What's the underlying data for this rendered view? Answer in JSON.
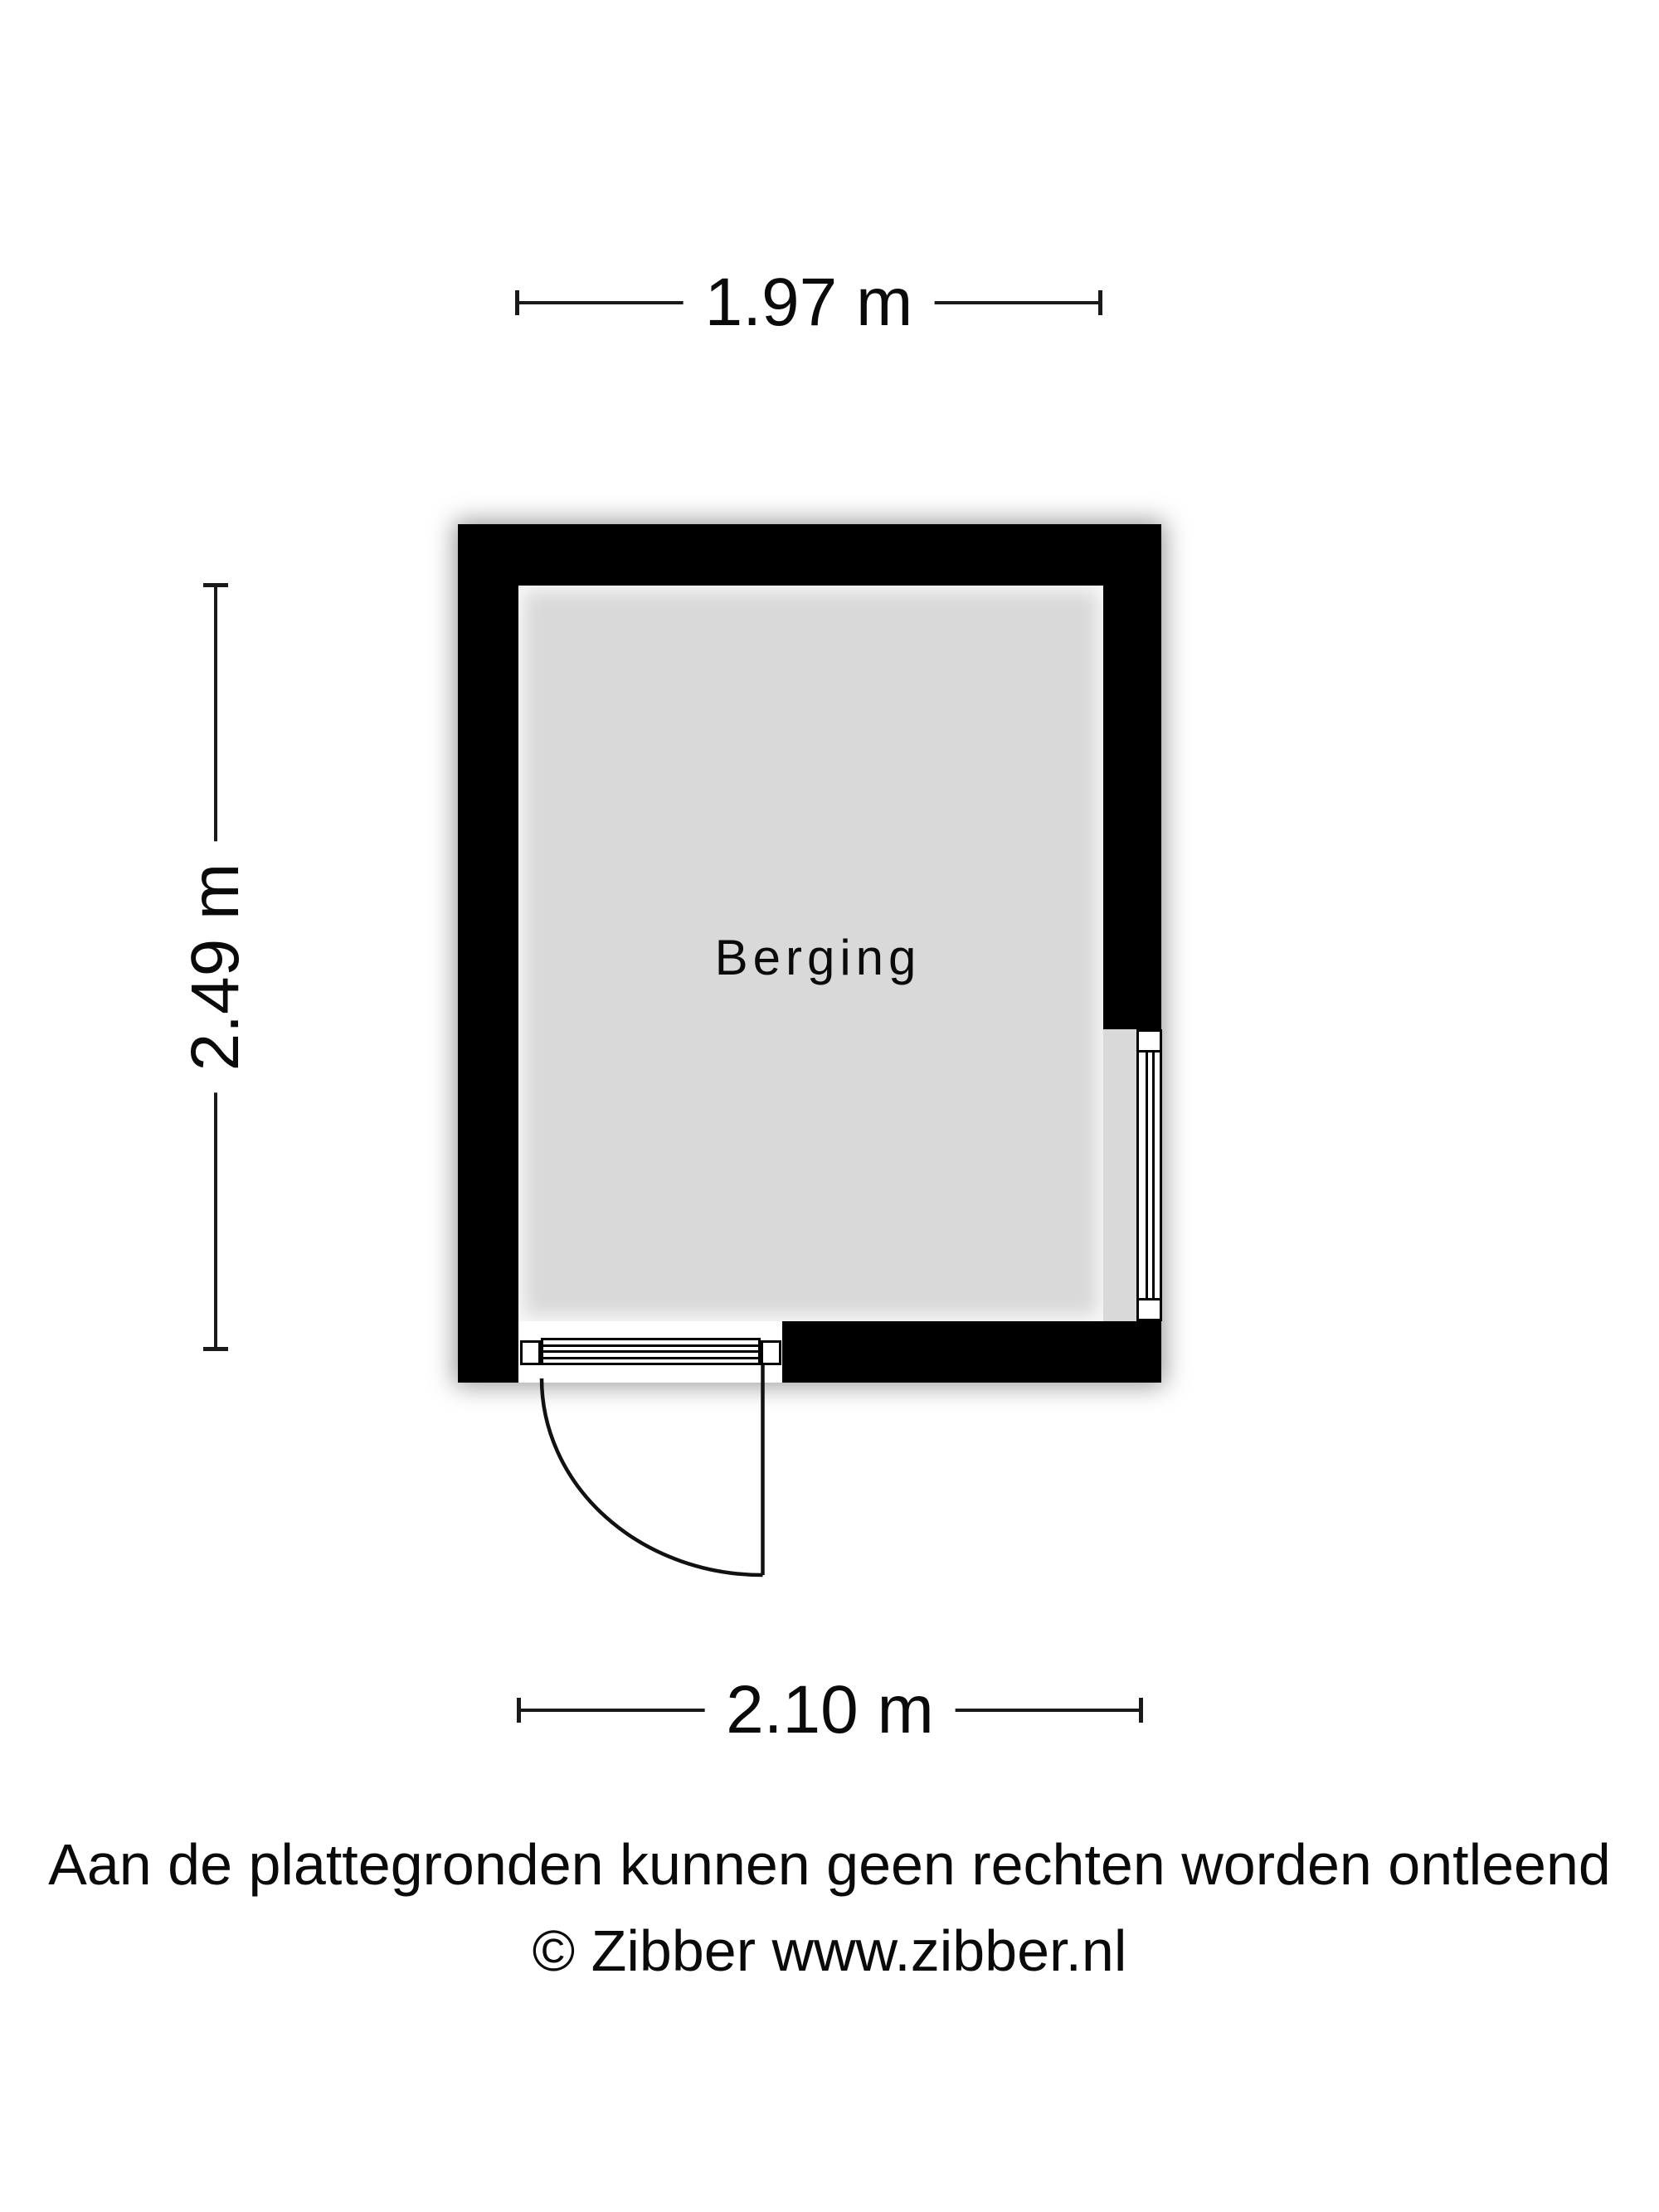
{
  "room": {
    "label": "Berging"
  },
  "dimensions": {
    "top": {
      "label": "1.97 m"
    },
    "left": {
      "label": "2.49 m"
    },
    "bottom": {
      "label": "2.10 m"
    }
  },
  "footer": {
    "disclaimer": "Aan de plattegronden kunnen geen rechten worden ontleend",
    "copyright": "© Zibber www.zibber.nl"
  },
  "colors": {
    "wall": "#000000",
    "floor": "#d9d9d9",
    "background": "#ffffff",
    "text": "#0a0a0a"
  }
}
